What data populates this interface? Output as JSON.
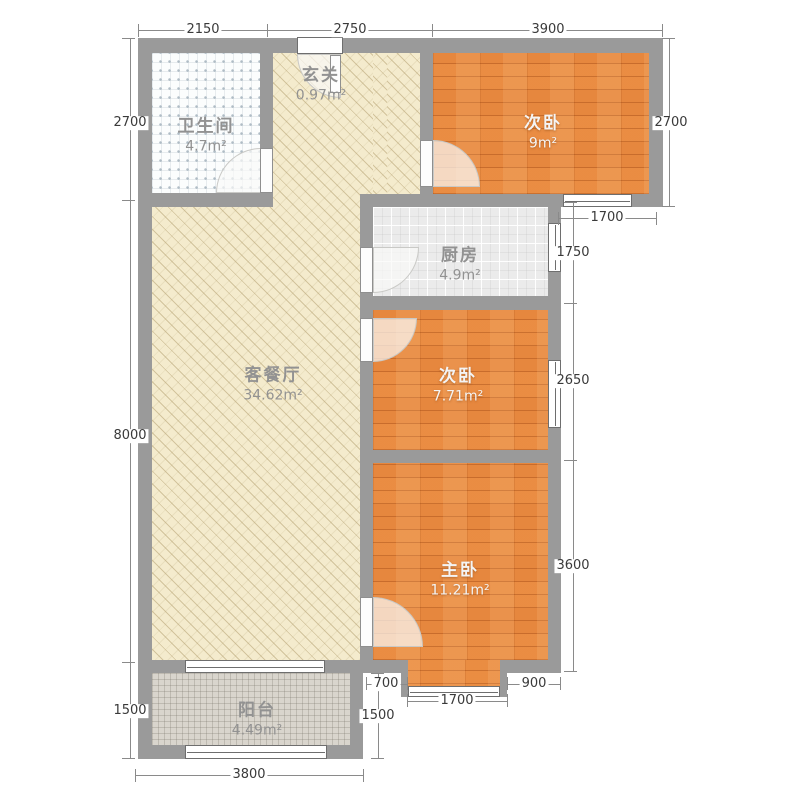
{
  "plan_title": "3-room apartment floor plan",
  "palette": {
    "wall": "#9a9a9a",
    "wood_floor": "#e6873e",
    "living_floor": "#f4ebcd",
    "kitchen_floor": "#ebebeb",
    "balcony_floor": "#d9d5cd",
    "bathroom_floor": "#fbfdfd",
    "dim_text": "#3a3a3a",
    "room_label_gray": "#929292",
    "room_label_white": "#f4f4f4"
  },
  "rooms": {
    "bathroom": {
      "name": "卫生间",
      "area": "4.7m²"
    },
    "entry": {
      "name": "玄关",
      "area": "0.97m²"
    },
    "bedroom_top": {
      "name": "次卧",
      "area": "9m²"
    },
    "kitchen": {
      "name": "厨房",
      "area": "4.9m²"
    },
    "living": {
      "name": "客餐厅",
      "area": "34.62m²"
    },
    "bedroom_mid": {
      "name": "次卧",
      "area": "7.71m²"
    },
    "master": {
      "name": "主卧",
      "area": "11.21m²"
    },
    "balcony": {
      "name": "阳台",
      "area": "4.49m²"
    }
  },
  "dims": {
    "top": [
      "2150",
      "2750",
      "3900"
    ],
    "left": [
      "2700",
      "8000",
      "1500"
    ],
    "right": [
      "2700",
      "1700",
      "1750",
      "2650",
      "3600"
    ],
    "bottom": [
      "3800"
    ],
    "lower": [
      "700",
      "1700",
      "900",
      "1500"
    ]
  }
}
